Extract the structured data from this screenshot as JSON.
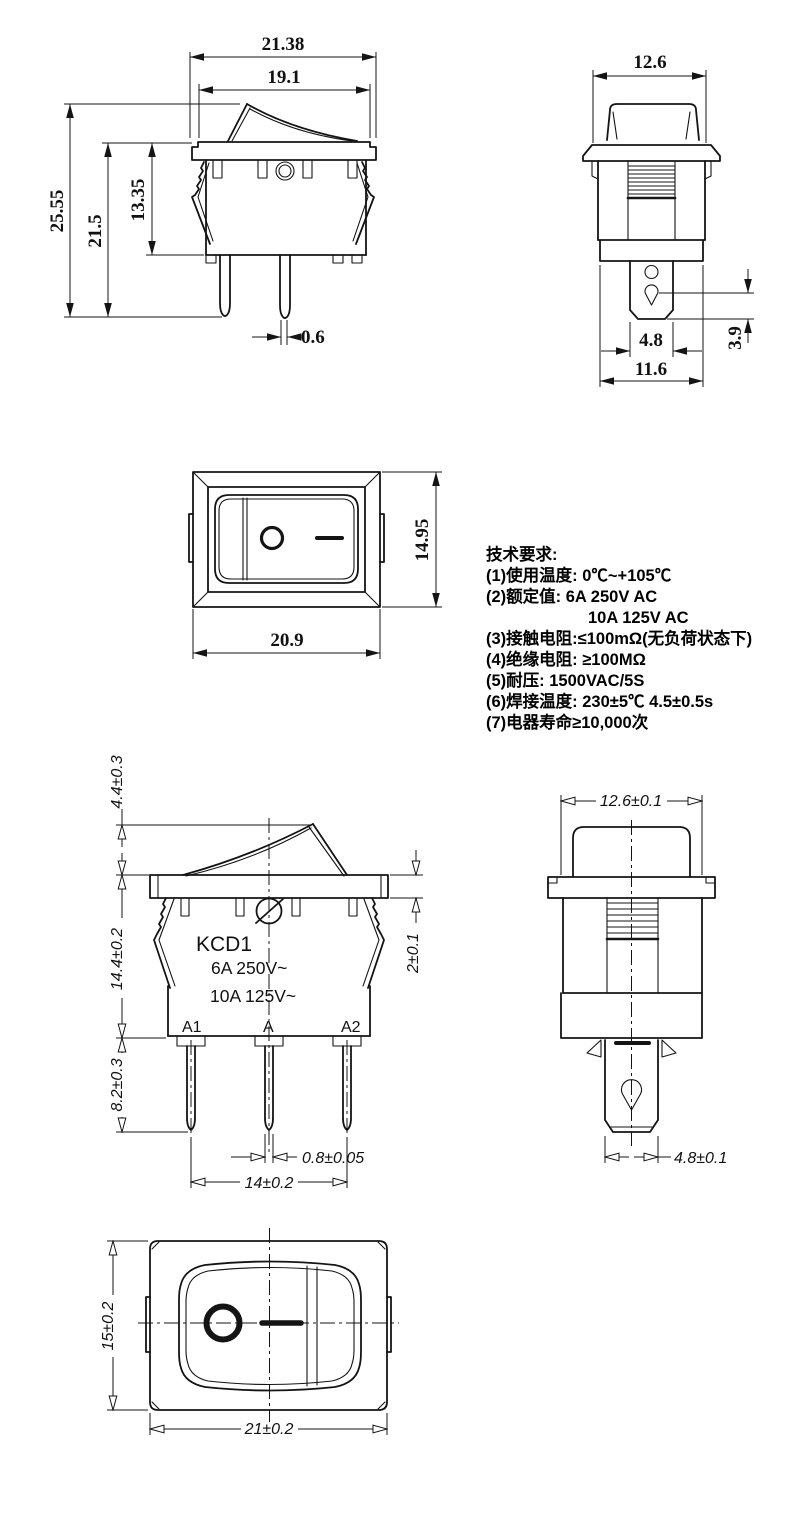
{
  "drawing": {
    "notes": {
      "title": "技术要求:",
      "lines": [
        "(1)使用温度:  0℃~+105℃",
        "(2)额定值:  6A 250V AC",
        "10A 125V AC",
        "(3)接触电阻:≤100mΩ(无负荷状态下)",
        "(4)绝缘电阻: ≥100MΩ",
        "(5)耐压: 1500VAC/5S",
        "(6)焊接温度: 230±5℃ 4.5±0.5s",
        "(7)电器寿命≥10,000次"
      ]
    },
    "front_upper": {
      "overall_width": "21.38",
      "rocker_width": "19.1",
      "total_height": "25.55",
      "height_flange_to_pin": "21.5",
      "body_height": "13.35",
      "pin_thickness": "0.6"
    },
    "side_upper": {
      "width": "12.6",
      "terminal_width": "4.8",
      "hole_to_tip": "3.9",
      "base_width": "11.6"
    },
    "top_middle": {
      "height": "14.95",
      "width": "20.9"
    },
    "front_lower": {
      "model": "KCD1",
      "rating_line1": "6A  250V~",
      "rating_line2": "10A 125V~",
      "terminal_a1": "A1",
      "terminal_a": "A",
      "terminal_a2": "A2",
      "rocker_height": "4.4±0.3",
      "body_height": "14.4±0.2",
      "pin_length": "8.2±0.3",
      "flange_thickness": "2±0.1",
      "pin_thickness": "0.8±0.05",
      "pin_pitch": "14±0.2"
    },
    "side_lower": {
      "width": "12.6±0.1",
      "terminal_width": "4.8±0.1"
    },
    "top_bottom": {
      "height": "15±0.2",
      "width": "21±0.2"
    }
  }
}
